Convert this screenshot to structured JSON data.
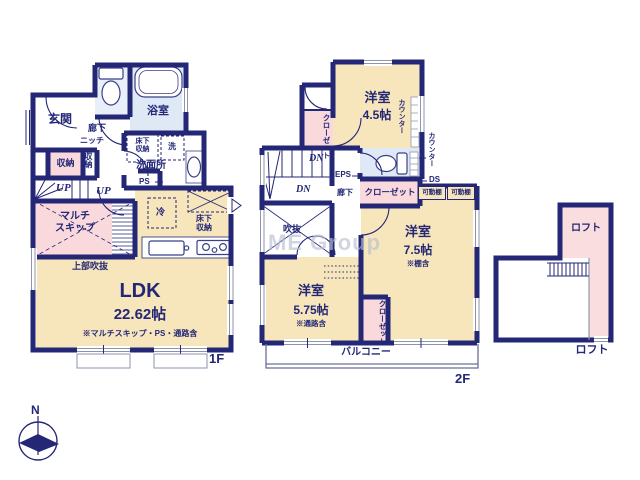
{
  "watermark": "ME Group",
  "compass": {
    "north": "N"
  },
  "floor1": {
    "label": "1F",
    "entrance": "玄関",
    "hallway": "廊下",
    "niche": "ニッチ",
    "storage_a": "収納",
    "storage_b": "収納",
    "bathroom": "浴室",
    "underfloor_storage_wash": "床下\n収納",
    "washer": "洗",
    "washroom": "洗面所",
    "ps": "PS",
    "fridge": "冷",
    "underfloor_storage_kitchen": "床下\n収納",
    "up_a": "UP",
    "up_b": "UP",
    "multi_skip": "マルチ\nスキップ",
    "upper_void": "上部吹抜",
    "ldk": {
      "name": "LDK",
      "size": "22.62帖",
      "note": "※マルチスキップ・PS・通路含"
    }
  },
  "floor2": {
    "label": "2F",
    "room_45": {
      "name": "洋室",
      "size": "4.5帖"
    },
    "room_75": {
      "name": "洋室",
      "size": "7.5帖",
      "note": "※棚含"
    },
    "room_575": {
      "name": "洋室",
      "size": "5.75帖",
      "note": "※通路含"
    },
    "closet_a": "クローゼット",
    "closet_b": "クローゼット",
    "closet_c": "クローゼット",
    "counter_a": "カウンター",
    "counter_b": "カウンター",
    "dn_a": "DN",
    "dn_b": "DN",
    "eps": "EPS",
    "hallway": "廊下",
    "ds": "DS",
    "shelf_a": "可動棚",
    "shelf_b": "可動棚",
    "void": "吹抜",
    "balcony": "バルコニー"
  },
  "loft": {
    "label_a": "ロフト",
    "label_b": "ロフト"
  }
}
